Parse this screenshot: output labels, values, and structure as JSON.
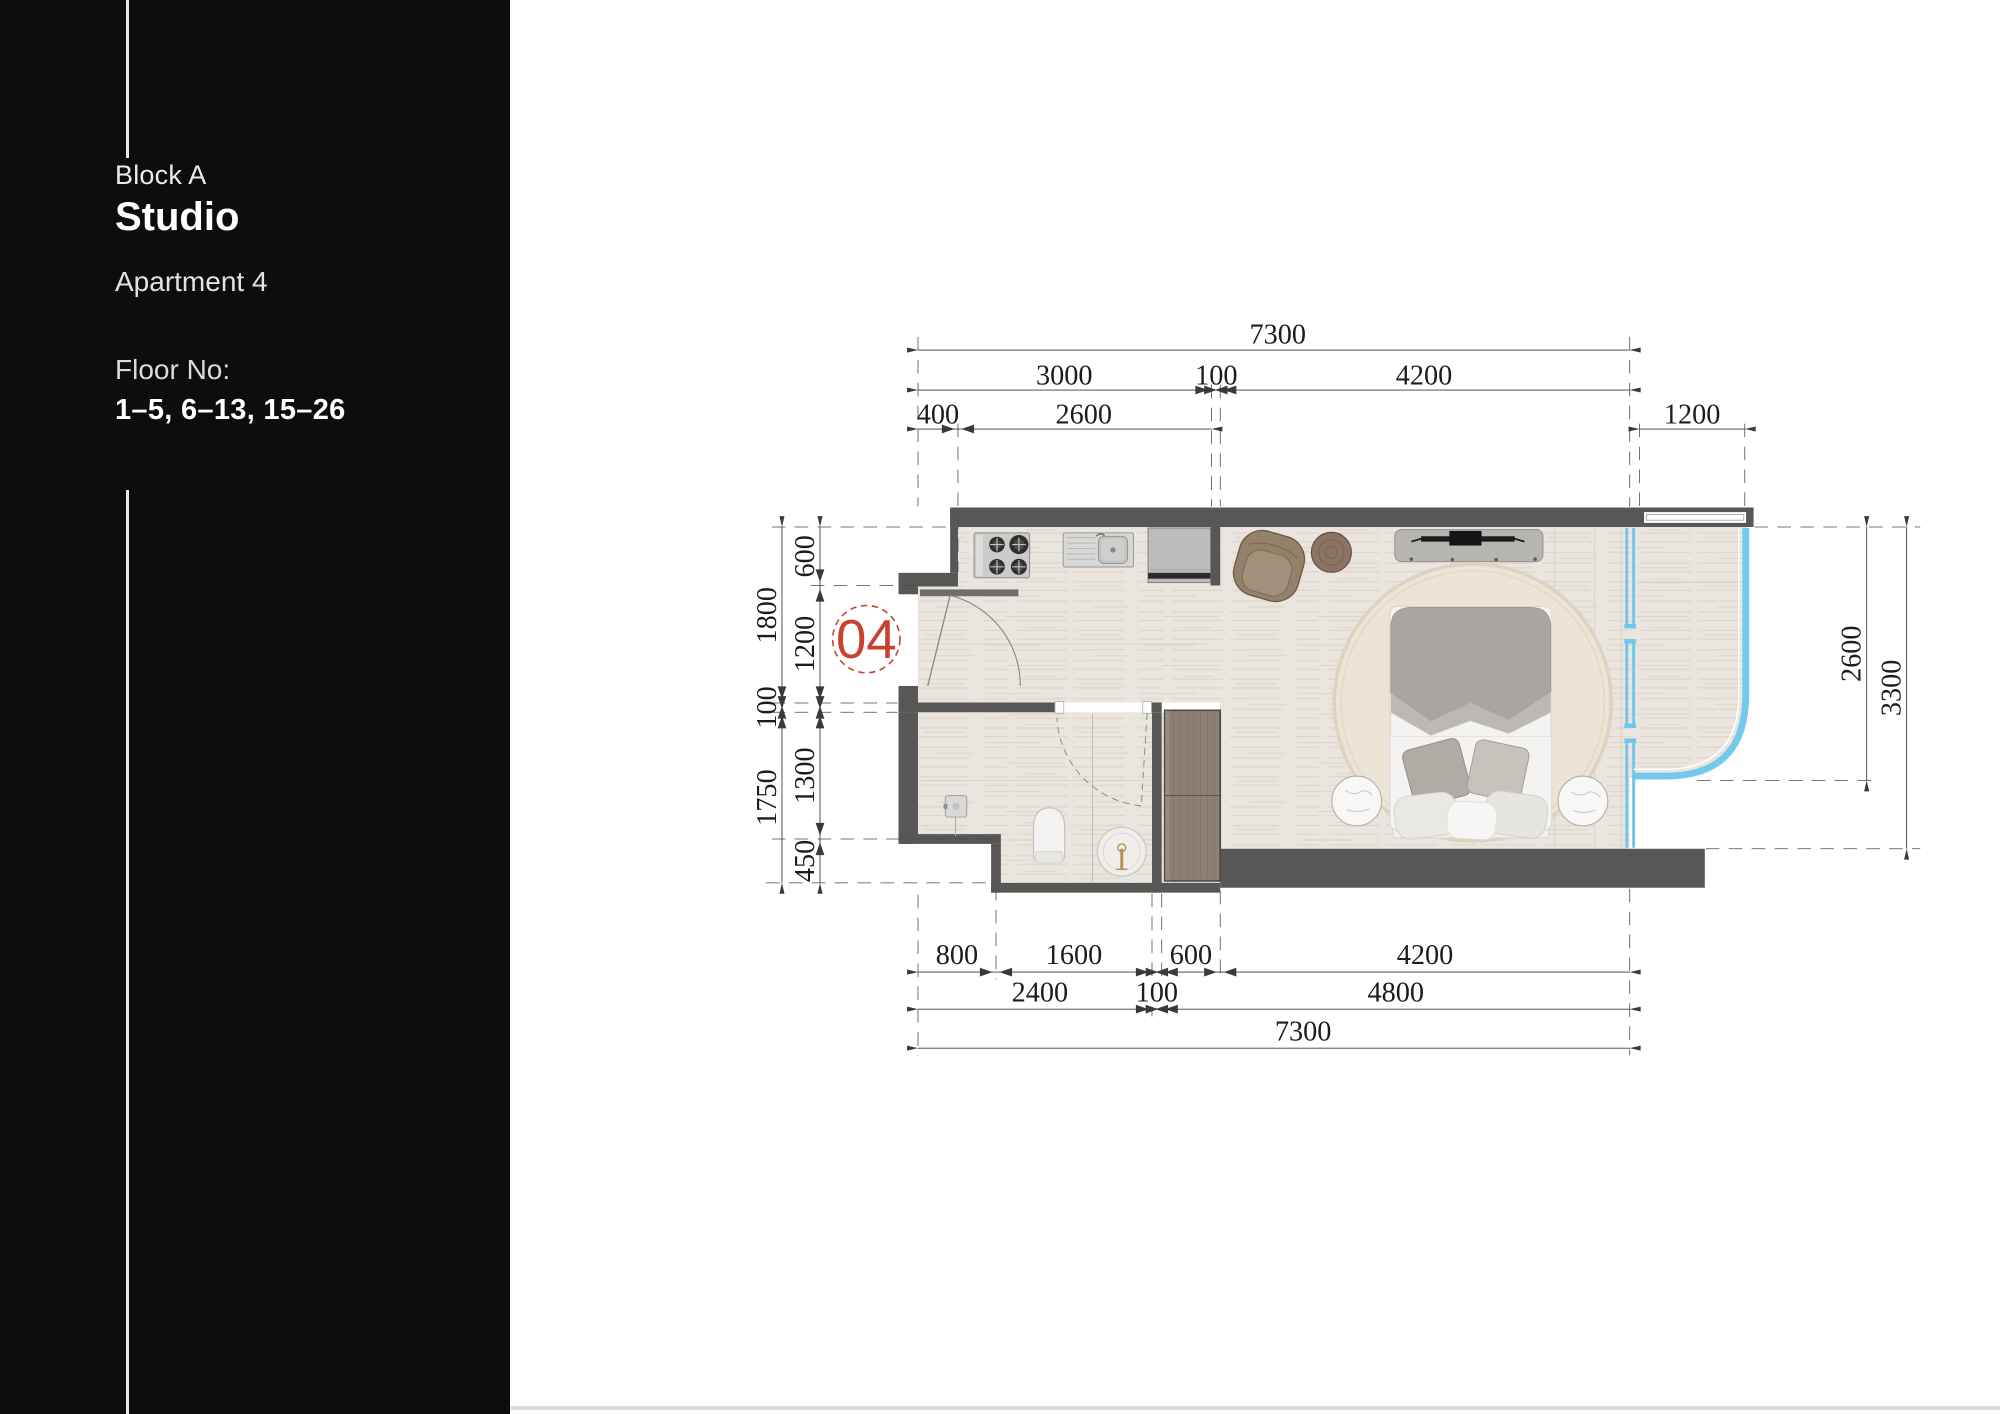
{
  "sidebar": {
    "block": "Block A",
    "unit_type": "Studio",
    "apartment": "Apartment 4",
    "floor_label": "Floor No:",
    "floors": "1–5, 6–13, 15–26"
  },
  "plan": {
    "unit_badge": "04",
    "dims": {
      "top": {
        "overall": "7300",
        "segments": [
          "3000",
          "100",
          "4200"
        ],
        "sub": [
          "400",
          "2600"
        ],
        "balcony_width": "1200"
      },
      "bottom": {
        "row1": [
          "800",
          "1600",
          "600",
          "4200"
        ],
        "row2": [
          "2400",
          "100",
          "4800"
        ],
        "overall": "7300"
      },
      "left": {
        "outer": [
          "1800",
          "100",
          "1750"
        ],
        "inner": [
          "600",
          "1200",
          "1300",
          "450"
        ]
      },
      "right": {
        "balcony_depth": "2600",
        "room_depth": "3300"
      }
    },
    "colors": {
      "wall": "#575756",
      "glass": "#6fc7e9",
      "floor": "#eae6df",
      "badge": "#c8402e",
      "sidebar_bg": "#0b0d0f"
    }
  }
}
